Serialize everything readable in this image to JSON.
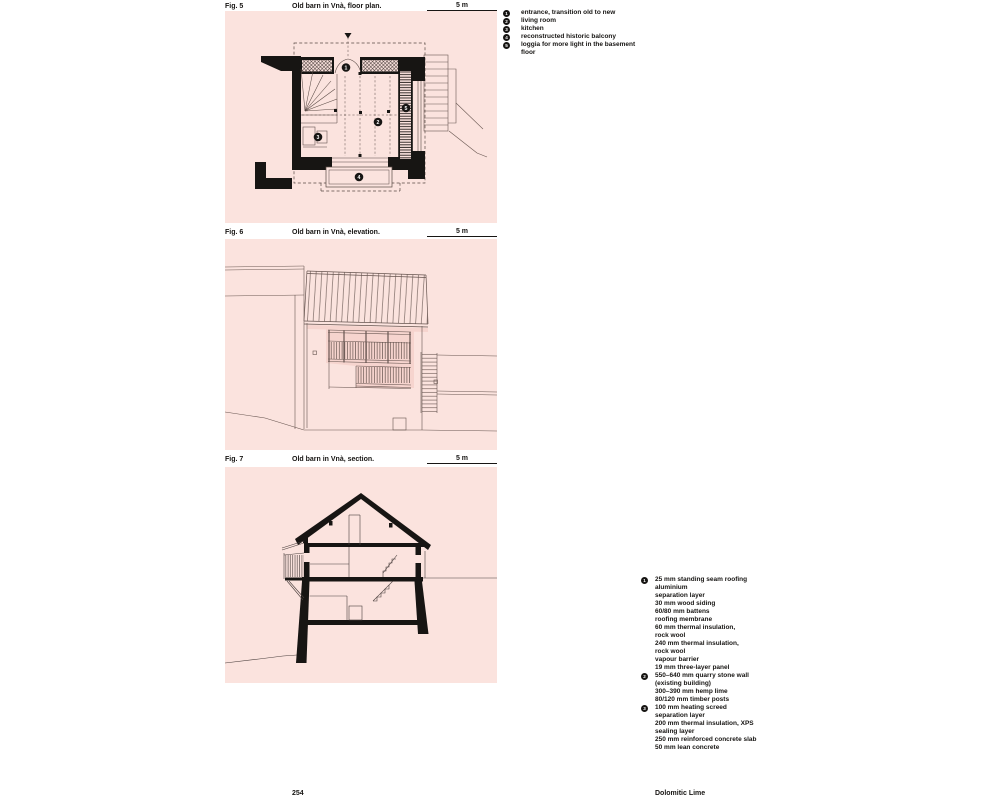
{
  "figures": [
    {
      "label": "Fig. 5",
      "title": "Old barn in Vnà, floor plan.",
      "scale_label": "5 m"
    },
    {
      "label": "Fig. 6",
      "title": "Old barn in Vnà, elevation.",
      "scale_label": "5 m"
    },
    {
      "label": "Fig. 7",
      "title": "Old barn in Vnà, section.",
      "scale_label": "5 m"
    }
  ],
  "plan_legend": {
    "items": [
      {
        "num": "1",
        "text": "entrance, transition old to new"
      },
      {
        "num": "2",
        "text": "living room"
      },
      {
        "num": "3",
        "text": "kitchen"
      },
      {
        "num": "4",
        "text": "reconstructed historic balcony"
      },
      {
        "num": "5",
        "text": "loggia for more light in the basement floor"
      }
    ]
  },
  "plan_markers": [
    "1",
    "2",
    "3",
    "4",
    "5"
  ],
  "section_legend": {
    "items": [
      {
        "num": "1",
        "text": "25 mm standing seam roofing\naluminium\nseparation layer\n30 mm wood siding\n60/80 mm battens\nroofing membrane\n60 mm thermal insulation,\nrock wool\n240 mm thermal insulation,\nrock wool\nvapour barrier\n19 mm three-layer panel"
      },
      {
        "num": "2",
        "text": "550–640 mm quarry stone wall\n(existing building)\n300–390 mm hemp lime\n80/120 mm timber posts"
      },
      {
        "num": "3",
        "text": "100 mm heating screed\nseparation layer\n200 mm thermal insulation, XPS\nsealing layer\n250 mm reinforced concrete slab\n50 mm lean concrete"
      }
    ]
  },
  "footer": {
    "page_number": "254",
    "chapter": "Dolomitic Lime"
  },
  "colors": {
    "panel_background": "#fbe3de",
    "shadow_pink": "#f6d4ce",
    "drawing_line": "#5a4a45",
    "ink": "#171513"
  }
}
